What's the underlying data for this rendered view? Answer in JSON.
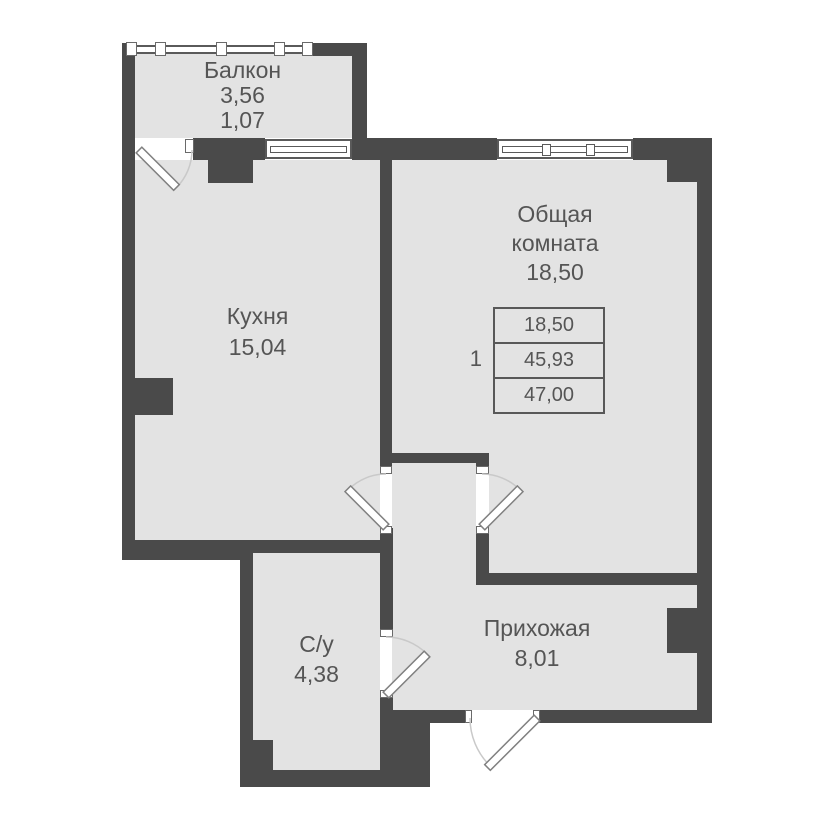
{
  "plan": {
    "colors": {
      "wall": "#4a4a4a",
      "floor": "#e3e3e3",
      "text": "#555555",
      "background": "#ffffff"
    },
    "rooms": {
      "balcony": {
        "name": "Балкон",
        "area": "3,56",
        "area_reduced": "1,07"
      },
      "kitchen": {
        "name": "Кухня",
        "area": "15,04"
      },
      "living": {
        "name_line1": "Общая",
        "name_line2": "комната",
        "area": "18,50"
      },
      "bathroom": {
        "name": "С/у",
        "area": "4,38"
      },
      "hallway": {
        "name": "Прихожая",
        "area": "8,01"
      }
    },
    "summary": {
      "unit_number": "1",
      "rows": [
        "18,50",
        "45,93",
        "47,00"
      ]
    }
  }
}
